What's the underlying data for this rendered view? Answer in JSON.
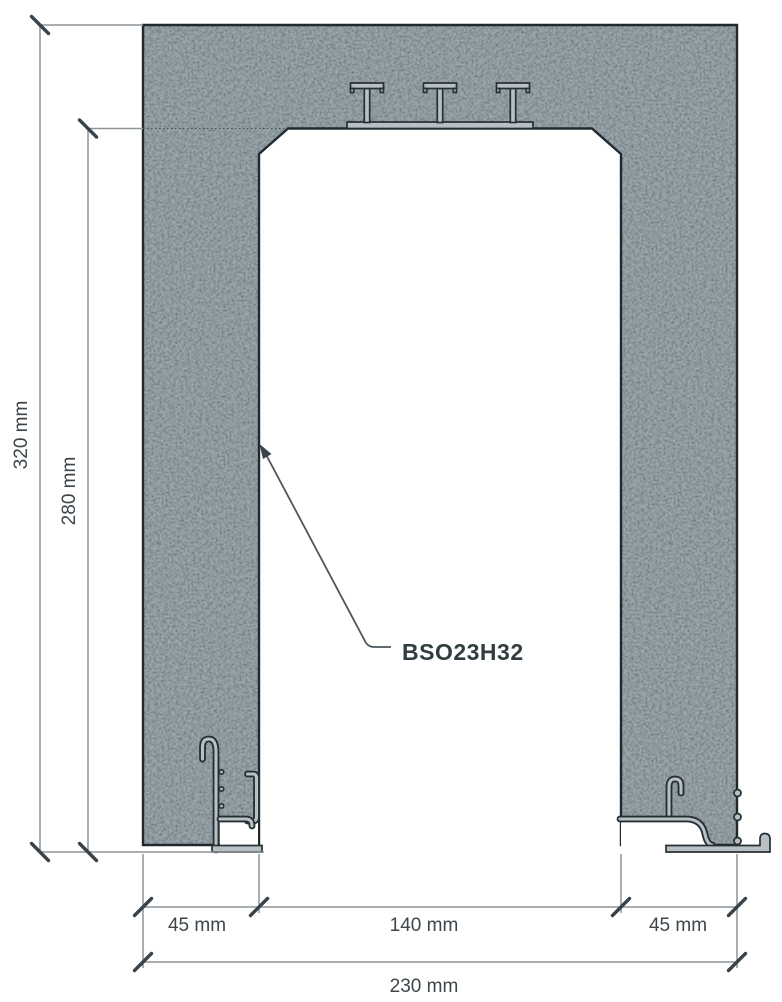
{
  "diagram": {
    "type": "technical cross-section drawing",
    "units": "mm",
    "product_code": "BSO23H32",
    "dimensions": [
      {
        "name": "overall-height",
        "label": "320 mm",
        "value": 320,
        "orientation": "vertical"
      },
      {
        "name": "opening-height",
        "label": "280 mm",
        "value": 280,
        "orientation": "vertical"
      },
      {
        "name": "left-jamb-width",
        "label": "45 mm",
        "value": 45,
        "orientation": "horizontal"
      },
      {
        "name": "opening-width",
        "label": "140 mm",
        "value": 140,
        "orientation": "horizontal"
      },
      {
        "name": "right-jamb-width",
        "label": "45 mm",
        "value": 45,
        "orientation": "horizontal"
      },
      {
        "name": "overall-width",
        "label": "230 mm",
        "value": 230,
        "orientation": "horizontal"
      }
    ],
    "annotation": {
      "label": "BSO23H32",
      "target": "inner face of left jamb"
    },
    "colors": {
      "concrete_base": "#8b99a0",
      "concrete_dark_speckle": "#3c4c54",
      "outline": "#1f292e",
      "metal_fill": "#b9c0c4",
      "metal_outline": "#252f34",
      "dimension_line": "#8b9499",
      "tick": "#39434a",
      "text": "#3d464b"
    }
  }
}
